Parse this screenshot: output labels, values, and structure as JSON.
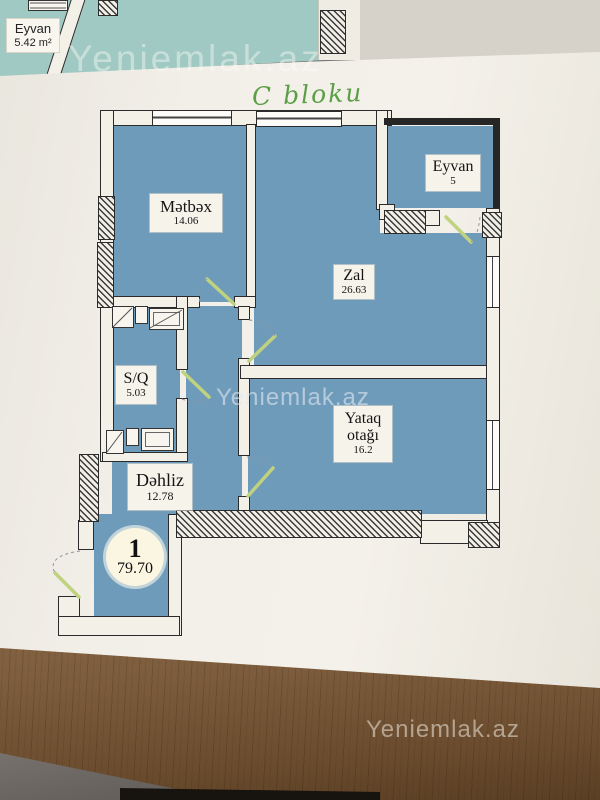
{
  "photo": {
    "handwriting": "C bloku",
    "watermark_top": "Yeniemlak.az",
    "watermark_center": "Yeniemlak.az",
    "watermark_bottom": "Yeniemlak.az"
  },
  "other_plan": {
    "room_name": "Eyvan",
    "room_area": "5.42 m²"
  },
  "plan": {
    "unit_number": "1",
    "total_area": "79.70",
    "rooms": [
      {
        "name": "Mətbəx",
        "area": "14.06"
      },
      {
        "name": "Zal",
        "area": "26.63"
      },
      {
        "name": "Eyvan",
        "area": "5"
      },
      {
        "name": "S/Q",
        "area": "5.03"
      },
      {
        "name": "Yataq otağı",
        "area": "16.2"
      },
      {
        "name": "Dəhliz",
        "area": "12.78"
      }
    ],
    "colors": {
      "room_fill": "#6f9bbb",
      "other_sheet_fill": "#9fc9c2",
      "door_leaf": "#bfd27e",
      "handwriting": "#5b9e46",
      "paper": "#f2efe8"
    }
  }
}
